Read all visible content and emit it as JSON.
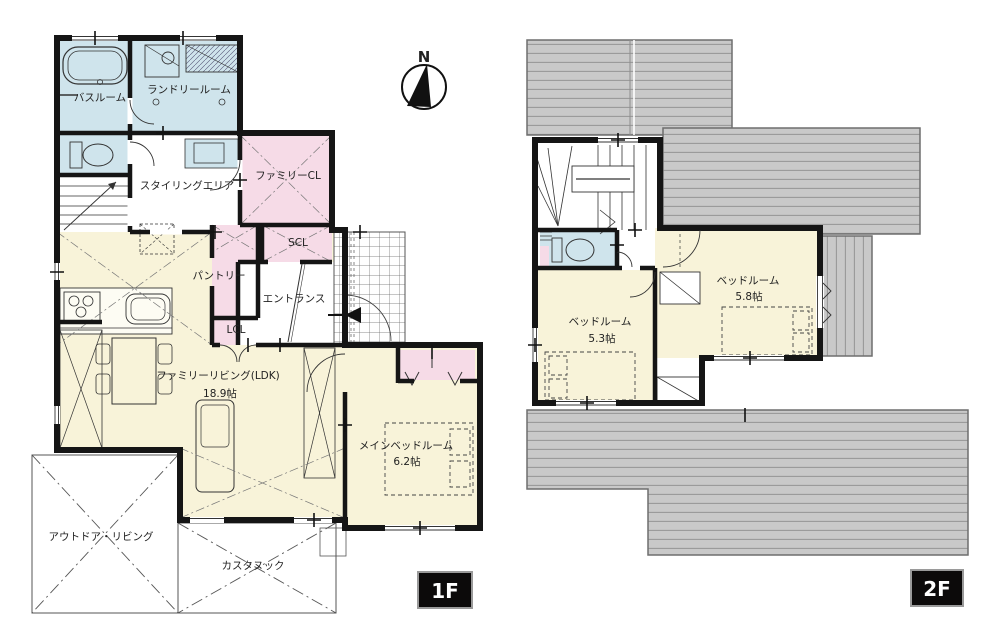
{
  "compass": {
    "north_label": "N"
  },
  "floor1": {
    "badge_label": "1F",
    "rooms": {
      "bathroom": "バスルーム",
      "laundry_room": "ランドリールーム",
      "styling_area": "スタイリングエリア",
      "family_closet": "ファミリーCL",
      "shoes_closet": "SCL",
      "pantry": "パントリー",
      "entrance": "エントランス",
      "living_closet": "LCL",
      "family_living": "ファミリーリビング(LDK)",
      "family_living_size": "18.9帖",
      "main_bedroom": "メインベッドルーム",
      "main_bedroom_size": "6.2帖",
      "outdoor_living": "アウトドア・リビング",
      "custom_nook": "カスタヌック"
    }
  },
  "floor2": {
    "badge_label": "2F",
    "rooms": {
      "bedroom_right": "ベッドルーム",
      "bedroom_right_size": "5.8帖",
      "bedroom_left": "ベッドルーム",
      "bedroom_left_size": "5.3帖"
    }
  },
  "colors": {
    "room_cream": "#f8f3d9",
    "wet_area_blue": "#cfe4ec",
    "closet_pink": "#f6dbe7",
    "roof_gray": "#c9c9c9",
    "wall_black": "#151515",
    "badge_bg": "#0c0a0a",
    "badge_text": "#ffffff"
  }
}
